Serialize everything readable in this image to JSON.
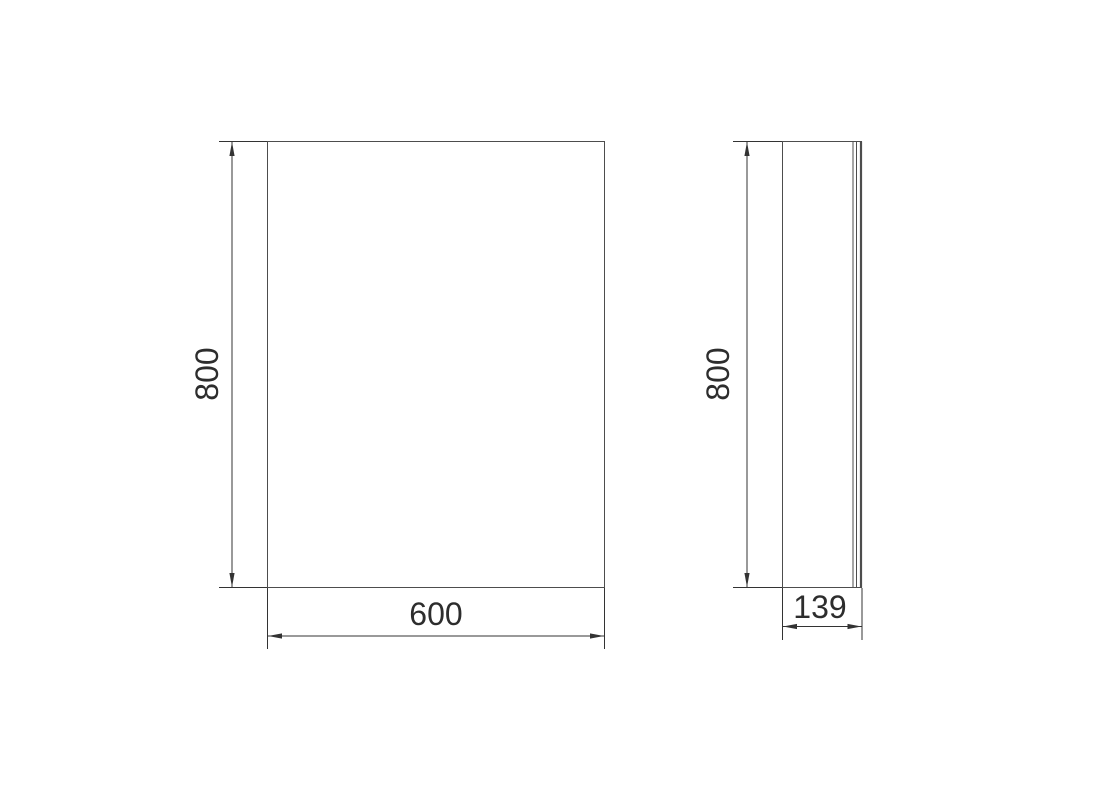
{
  "canvas": {
    "background": "#ffffff",
    "outline_color": "#4d4d4d",
    "dimension_color": "#333333",
    "text_color": "#2d2d2d"
  },
  "drawing": {
    "type": "technical-drawing",
    "description": "Two orthographic views of a mirror cabinet: front view and side view with dimensions",
    "views": [
      {
        "id": "front",
        "label": "front view"
      },
      {
        "id": "side",
        "label": "side view"
      }
    ],
    "dimensions": {
      "front_height": "800",
      "front_width": "600",
      "side_height": "800",
      "side_depth": "139"
    }
  }
}
